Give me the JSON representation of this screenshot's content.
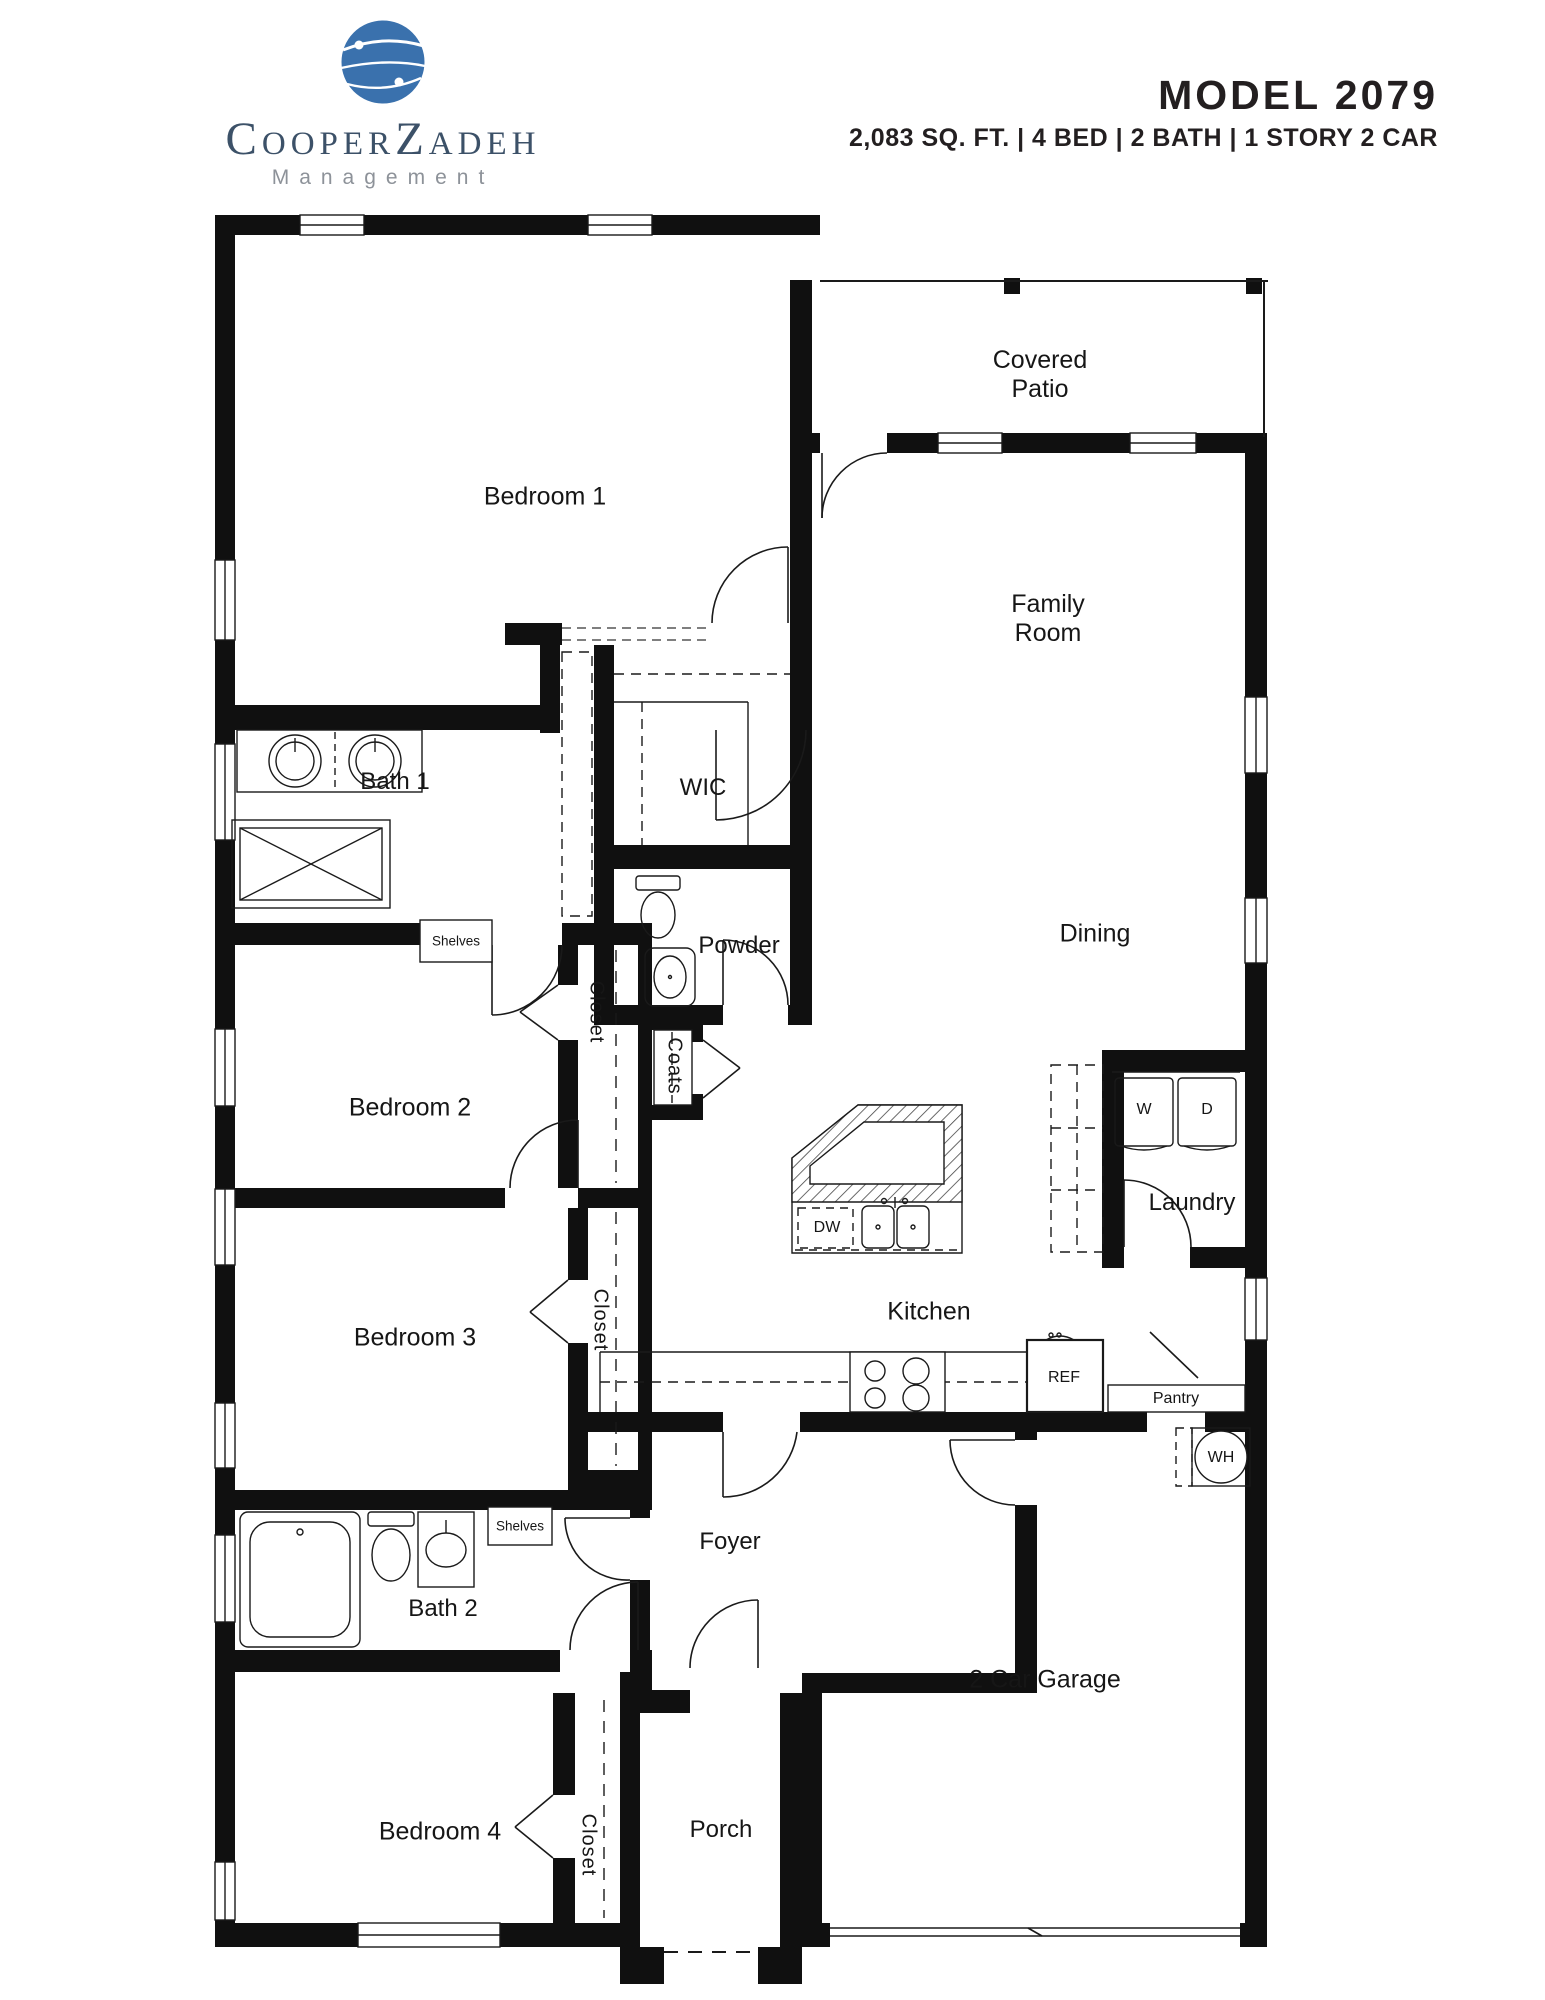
{
  "header": {
    "brand": "CooperZadeh",
    "brand_sub": "Management",
    "model": "MODEL 2079",
    "specs": "2,083 SQ. FT. | 4 BED | 2 BATH | 1 STORY 2 CAR"
  },
  "colors": {
    "logo_blue": "#3a71ad",
    "brand_text": "#3c5168",
    "subtitle_gray": "#8d9299",
    "title_dark": "#231f20",
    "wall_black": "#101010"
  },
  "rooms": {
    "bedroom1": "Bedroom 1",
    "covered_patio": {
      "line1": "Covered",
      "line2": "Patio"
    },
    "family_room": {
      "line1": "Family",
      "line2": "Room"
    },
    "bath1": "Bath 1",
    "wic": "WIC",
    "powder": "Powder",
    "bedroom2": "Bedroom 2",
    "dining": "Dining",
    "laundry": "Laundry",
    "kitchen": "Kitchen",
    "bedroom3": "Bedroom 3",
    "bath2": "Bath 2",
    "foyer": "Foyer",
    "bedroom4": "Bedroom 4",
    "porch": "Porch",
    "garage": "2 Car Garage",
    "pantry": "Pantry"
  },
  "fixtures": {
    "washer": "W",
    "dryer": "D",
    "dishwasher": "DW",
    "refrigerator": "REF",
    "water_heater": "WH",
    "shelves_bath1": "Shelves",
    "shelves_bath2": "Shelves",
    "closet_bedroom2": "Closet",
    "closet_bedroom3": "Closet",
    "closet_bedroom4": "Closet",
    "coats": "Coats"
  }
}
